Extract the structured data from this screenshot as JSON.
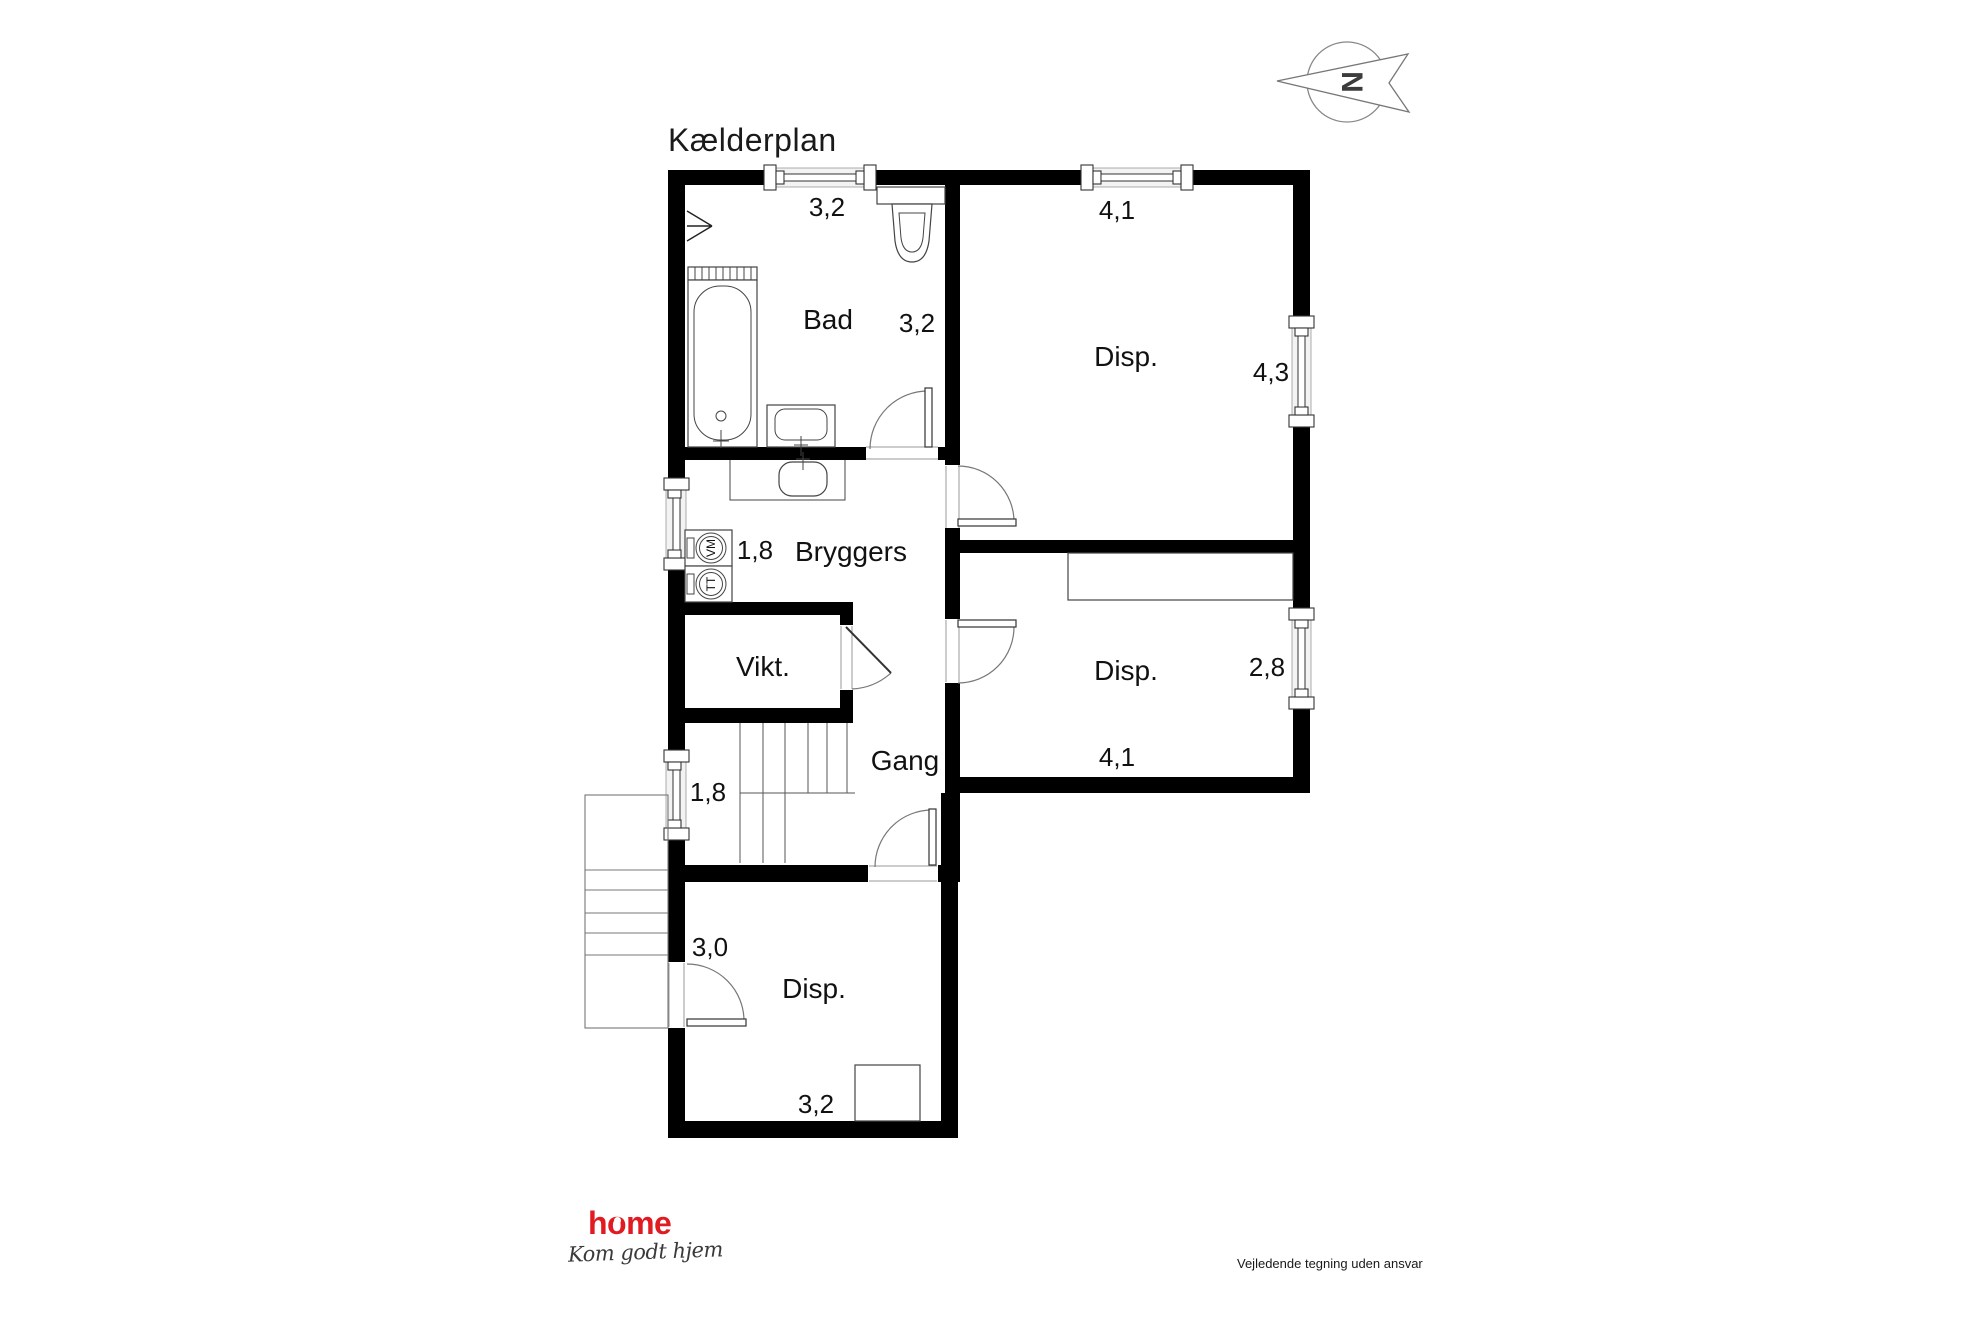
{
  "page": {
    "title": "Kælderplan",
    "disclaimer": "Vejledende tegning uden ansvar"
  },
  "compass": {
    "north_label": "N"
  },
  "rooms": {
    "bad": {
      "name": "Bad",
      "width_m": "3,2",
      "depth_m": "3,2"
    },
    "disp_top": {
      "name": "Disp.",
      "width_m": "4,1",
      "depth_m": "4,3"
    },
    "bryggers": {
      "name": "Bryggers",
      "window_m": "1,8"
    },
    "vikt": {
      "name": "Vikt."
    },
    "gang": {
      "name": "Gang",
      "window_m": "1,8"
    },
    "disp_right": {
      "name": "Disp.",
      "depth_m": "2,8",
      "width_m": "4,1"
    },
    "disp_bottom": {
      "name": "Disp.",
      "depth_m": "3,0",
      "width_m": "3,2"
    }
  },
  "appliances": {
    "washing_machine": "VM",
    "tumble_dryer": "TT"
  },
  "logo": {
    "text": "home",
    "tagline": "Kom godt hjem"
  },
  "colors": {
    "wall": "#000000",
    "logo_red": "#e11b22",
    "line": "#555555"
  }
}
